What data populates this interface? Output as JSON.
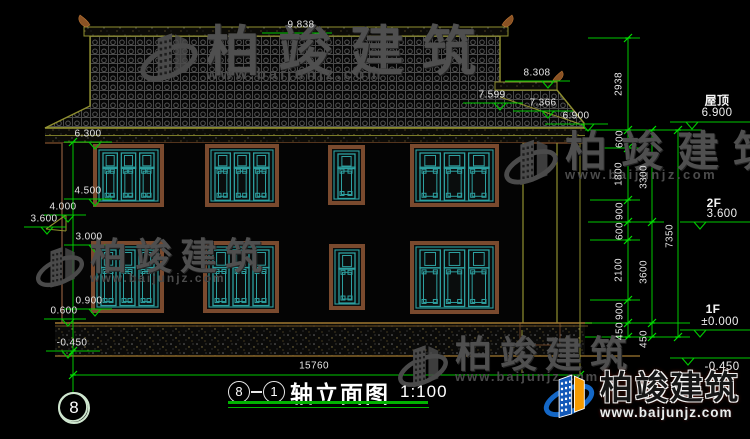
{
  "watermark": {
    "brand": "柏竣建筑",
    "site": "www.baijunjz.com"
  },
  "brand_footer": {
    "brand": "柏竣建筑",
    "site": "www.baijunjz.com"
  },
  "title": {
    "axis_start": "8",
    "axis_end": "1",
    "name": "轴立面图",
    "scale": "1:100"
  },
  "axis_bubble": "8",
  "dim_bottom": "15760",
  "elevations_top": [
    "9.838",
    "8.308",
    "7.599",
    "7.366",
    "6.900"
  ],
  "elevations_left": [
    "6.300",
    "4.500",
    "4.000",
    "3.600",
    "3.000",
    "0.900",
    "0.600",
    "-0.450"
  ],
  "levels_right": [
    {
      "name": "屋顶",
      "value": "6.900"
    },
    {
      "name": "2F",
      "value": "3.600"
    },
    {
      "name": "1F",
      "value": "±0.000"
    },
    {
      "name": "",
      "value": "-0.450"
    }
  ],
  "dims_right_inner": [
    "2938",
    "600",
    "1800",
    "900",
    "600",
    "2100",
    "900",
    "450"
  ],
  "dims_right_mid": [
    "3300",
    "3600",
    "450"
  ],
  "dims_right_outer": [
    "7350"
  ]
}
